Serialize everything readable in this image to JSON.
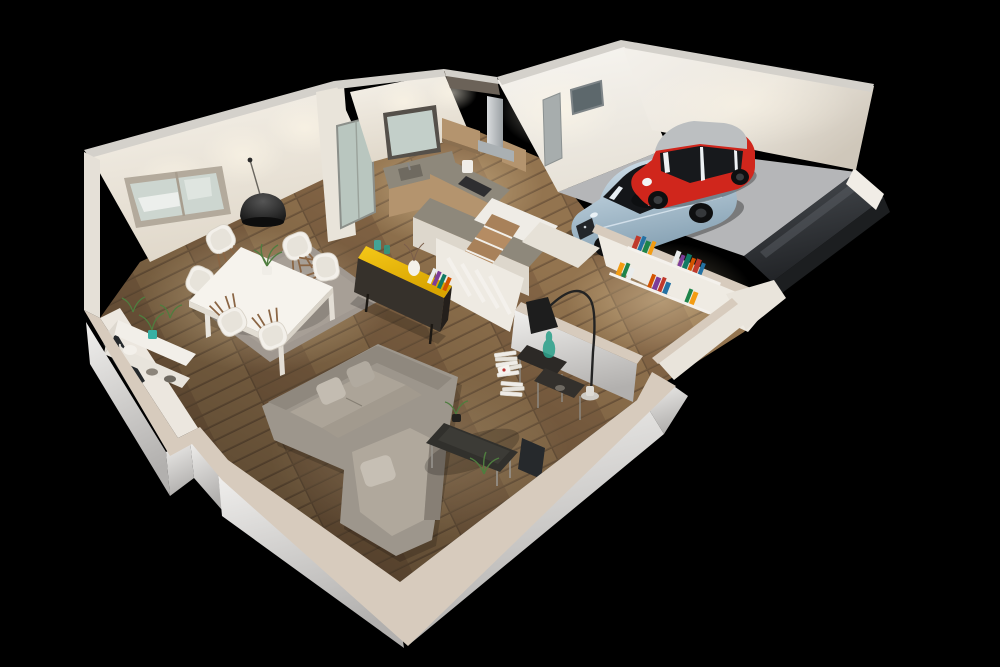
{
  "scene": {
    "title": "3D cutaway floor plan night render",
    "style": "dollhouse isometric render on black backdrop",
    "rooms": [
      {
        "id": "living-room",
        "label": "Living room",
        "furniture": [
          "corner sofa",
          "coffee table",
          "nesting side tables",
          "floor lamp",
          "console shelf",
          "book stacks",
          "leaning panel",
          "plants"
        ]
      },
      {
        "id": "dining-area",
        "label": "Dining area",
        "furniture": [
          "white dining table",
          "6 shell chairs",
          "gray rug",
          "black dome pendant",
          "wall window"
        ]
      },
      {
        "id": "kitchen",
        "label": "Kitchen",
        "furniture": [
          "L-shaped counter",
          "wall cabinets",
          "range hood",
          "sink window",
          "glass door",
          "bar counter"
        ]
      },
      {
        "id": "staircase",
        "label": "Staircase",
        "furniture": [
          "winder stairs",
          "white railing",
          "yellow sideboard with books"
        ]
      },
      {
        "id": "hallway",
        "label": "Hallway",
        "furniture": [
          "wall bookshelves",
          "colorful books"
        ]
      },
      {
        "id": "garage",
        "label": "Garage",
        "furniture": [
          "red city car",
          "silver-blue sedan",
          "small window",
          "side door",
          "dark driveway slab"
        ]
      }
    ],
    "vehicles": [
      {
        "id": "silver-sedan",
        "body_color": "#a9c3d4"
      },
      {
        "id": "red-city-car",
        "body_color": "#d0261c",
        "roof_color": "#bcbfc1"
      }
    ],
    "palette": {
      "background": "#000000",
      "wall_lit": "#f1ede6",
      "wall_shade": "#ddd6cb",
      "wall_top_gray": "#d4d1cb",
      "cut_top_beige": "#d7cbbd",
      "floor_wood": "#8d6e4e",
      "floor_wood_dark": "#5f4a33",
      "rug_gray": "#a09890",
      "sofa_gray": "#9d968c",
      "sofa_light": "#b6aea3",
      "accent_yellow": "#eab600",
      "sideboard_dark": "#36312b",
      "counter_gray": "#8e887b",
      "cabinet_wood": "#b4946e",
      "concrete": "#b5b6b8",
      "slab_dark": "#35383c",
      "car_red": "#d0261c",
      "car_roof_silver": "#bcbfc1",
      "car_silver_blue": "#a9c3d4",
      "car_glass": "#17191c",
      "glass_tint": "#b9c6bf",
      "lamp_black": "#1d1d1d",
      "plant_green": "#4f7d3f",
      "teal_pot": "#38b0a4",
      "book_colors": [
        "#c0392b",
        "#2471a3",
        "#1e8449",
        "#f39c12",
        "#eaeded",
        "#7d3c98",
        "#117a65",
        "#d35400",
        "#c0392b",
        "#2471a3",
        "#f39c12",
        "#1e8449",
        "#eaeded",
        "#d35400",
        "#7d3c98"
      ]
    }
  }
}
